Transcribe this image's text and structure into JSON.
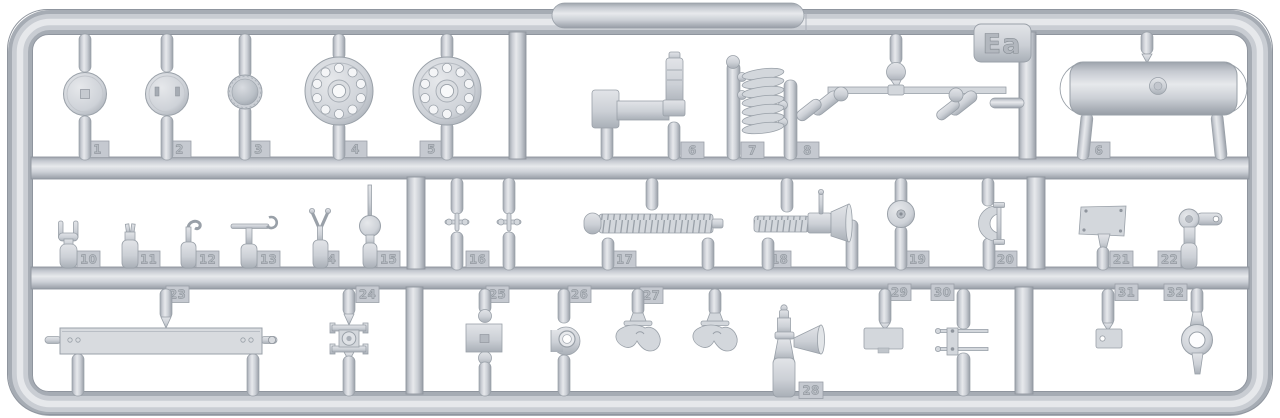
{
  "sprue": {
    "code": "Ea"
  },
  "colors": {
    "background": "#ffffff",
    "plastic": "#c9cdd4",
    "plastic_light": "#e8eaed",
    "plastic_dark": "#99a0a8",
    "tab": "#c5c9d0",
    "number": "#b5bac1"
  },
  "parts": [
    {
      "number": "1"
    },
    {
      "number": "2"
    },
    {
      "number": "3"
    },
    {
      "number": "4"
    },
    {
      "number": "5"
    },
    {
      "number": "6"
    },
    {
      "number": "7"
    },
    {
      "number": "8"
    },
    {
      "number": "9"
    },
    {
      "number": "10"
    },
    {
      "number": "11"
    },
    {
      "number": "12"
    },
    {
      "number": "13"
    },
    {
      "number": "14"
    },
    {
      "number": "15"
    },
    {
      "number": "16"
    },
    {
      "number": "17"
    },
    {
      "number": "18"
    },
    {
      "number": "19"
    },
    {
      "number": "20"
    },
    {
      "number": "21"
    },
    {
      "number": "22"
    },
    {
      "number": "23"
    },
    {
      "number": "24"
    },
    {
      "number": "25"
    },
    {
      "number": "26"
    },
    {
      "number": "27"
    },
    {
      "number": "28"
    },
    {
      "number": "29"
    },
    {
      "number": "30"
    },
    {
      "number": "31"
    },
    {
      "number": "32"
    }
  ]
}
